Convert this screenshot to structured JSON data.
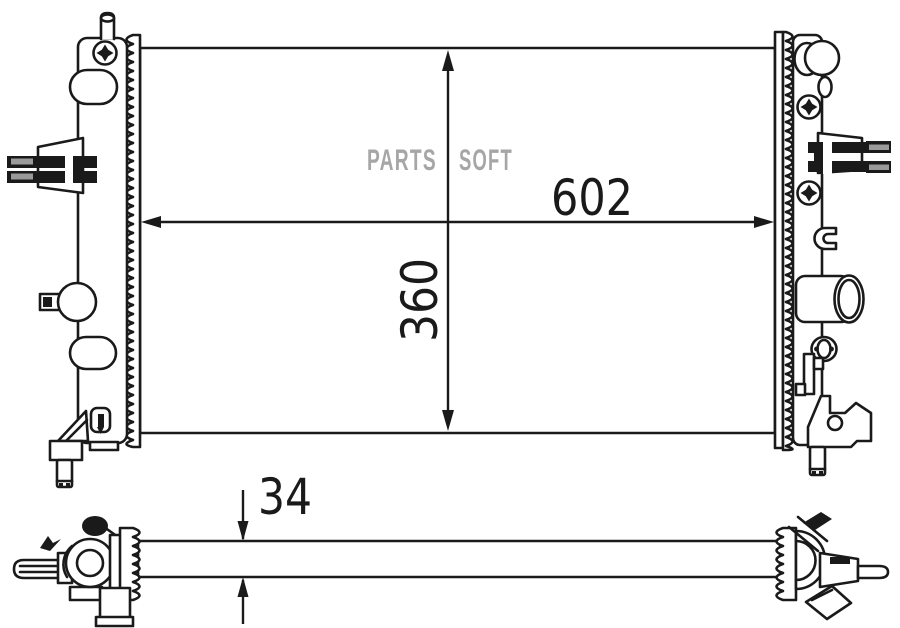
{
  "watermark": {
    "left": "PARTS",
    "right": "SOFT"
  },
  "dimensions": {
    "width": "602",
    "height": "360",
    "thickness": "34"
  },
  "colors": {
    "line": "#1a1a1a",
    "watermark": "#a6a6a6",
    "pin_metal": "#9a9a9a",
    "background": "#ffffff"
  }
}
